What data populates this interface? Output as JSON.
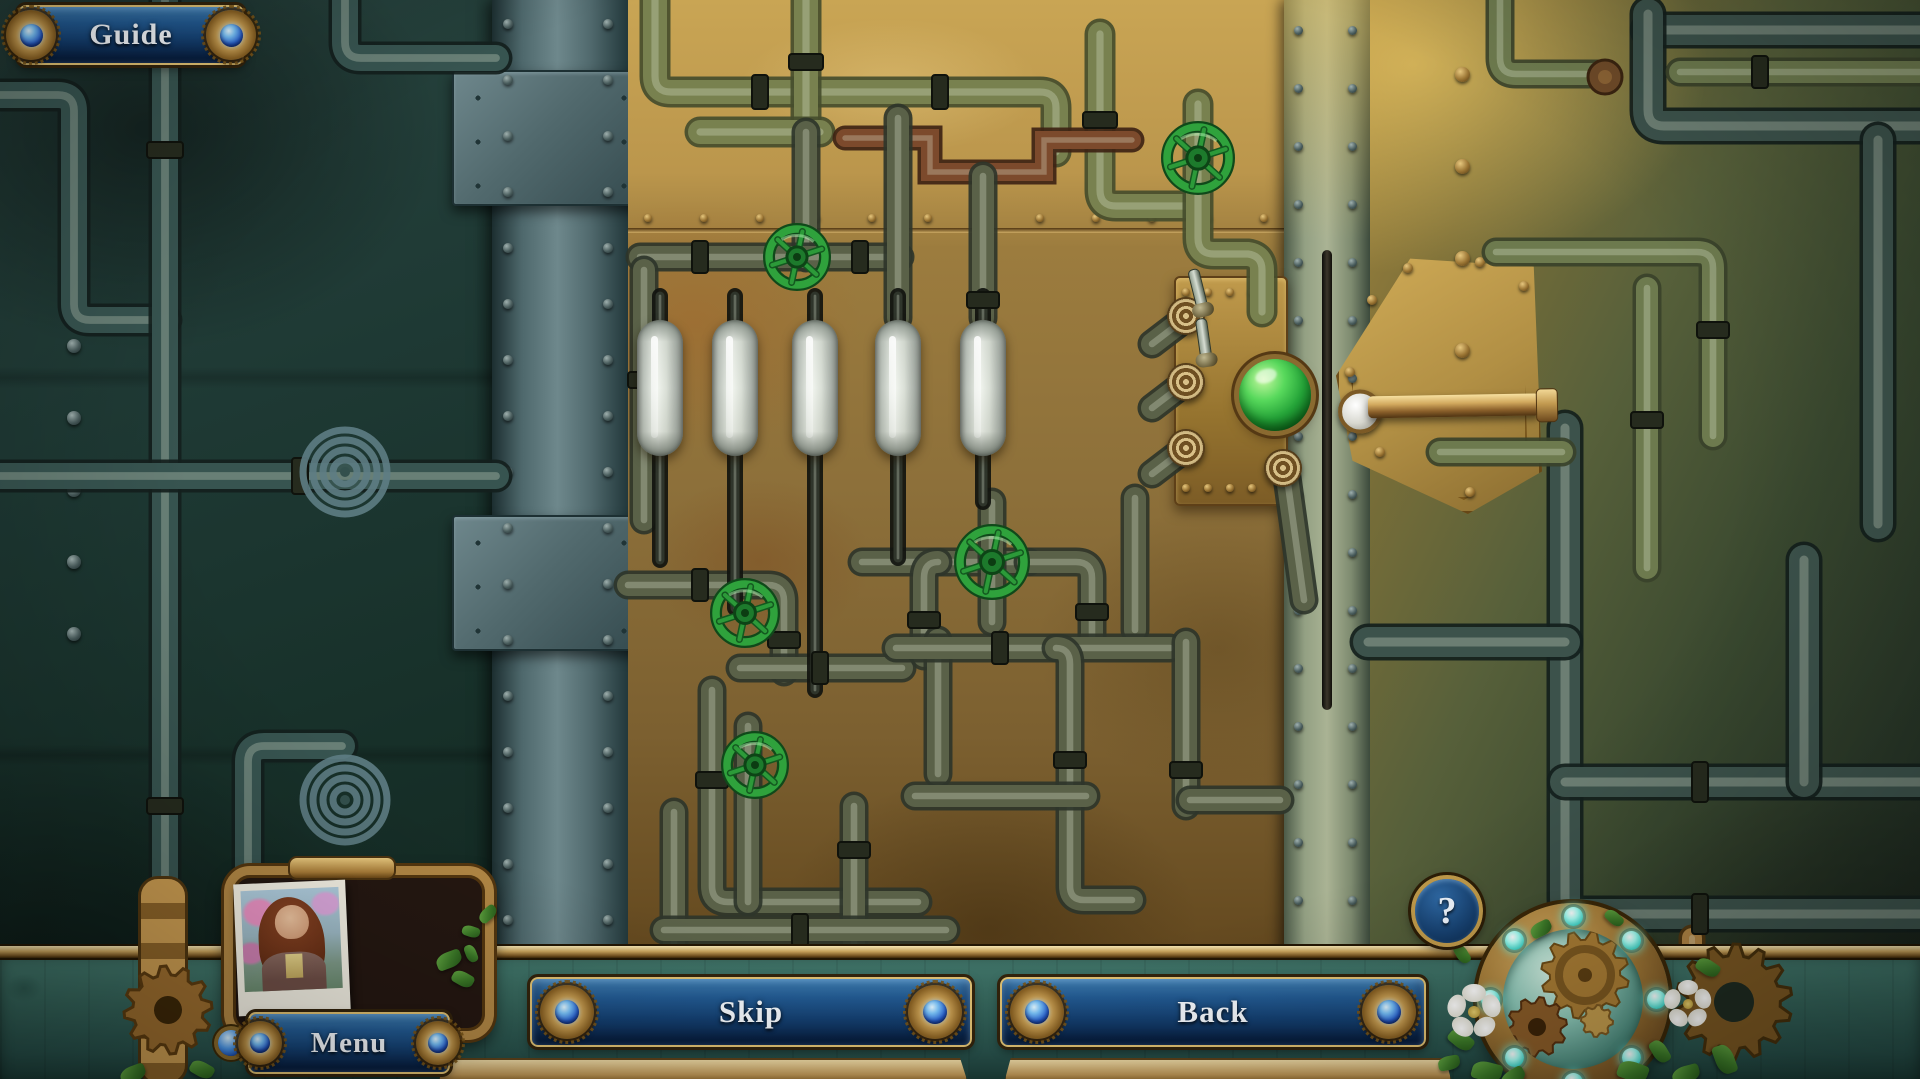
{
  "hud": {
    "guide": {
      "label": "Guide"
    },
    "skip": {
      "label": "Skip"
    },
    "back": {
      "label": "Back"
    },
    "menu": {
      "label": "Menu"
    },
    "help": {
      "label": "?"
    }
  },
  "icons": {
    "help": "question-mark",
    "banner_ornament": "blue-gem-rosette",
    "portrait": "woman-polaroid-photo",
    "device": "gear-compass-device",
    "valve": "green-handwheel",
    "gauge": "needle-dial"
  },
  "colors": {
    "banner_blue": "#1d4f7a",
    "banner_blue_dark": "#0c2c52",
    "gold_trim": "#c9a44e",
    "valve_green": "#2fa23c",
    "gauge_green": "#3fae4a",
    "needle_red": "#c4232f",
    "dome_green": "#24a338",
    "glow_cyan": "#7ff0ea",
    "brass_panel": "#8d703a",
    "teal_wall": "#1f3a35"
  },
  "puzzle": {
    "valves": [
      {
        "x": 797,
        "y": 257,
        "r": 28
      },
      {
        "x": 1198,
        "y": 158,
        "r": 31
      },
      {
        "x": 992,
        "y": 562,
        "r": 32
      },
      {
        "x": 745,
        "y": 613,
        "r": 29
      },
      {
        "x": 755,
        "y": 765,
        "r": 28
      }
    ],
    "gauges": [
      {
        "x": 898,
        "y": 182,
        "r": 46,
        "green_start": 0,
        "green_end": 115,
        "needle": 205
      },
      {
        "x": 983,
        "y": 252,
        "r": 46,
        "green_start": 140,
        "green_end": 215,
        "needle": 108
      },
      {
        "x": 1135,
        "y": 564,
        "r": 46,
        "green_start": 355,
        "green_end": 178,
        "needle": 93
      },
      {
        "x": 977,
        "y": 697,
        "r": 47,
        "green_start": 315,
        "green_end": 105,
        "needle": 30
      },
      {
        "x": 1190,
        "y": 717,
        "r": 47,
        "green_start": 185,
        "green_end": 300,
        "needle": 133
      }
    ],
    "cylinders": {
      "count": 5,
      "state": "empty",
      "x": [
        660,
        735,
        815,
        898,
        983
      ],
      "top": 320,
      "width": 46,
      "height": 136
    },
    "dome_button": {
      "x": 1275,
      "y": 395,
      "r": 36,
      "state": "lit-green"
    },
    "lever": {
      "x": 1352,
      "y": 404,
      "length": 205
    },
    "sockets": {
      "count": 4
    },
    "toggles": {
      "count": 2
    },
    "device_dots": {
      "count": 8
    }
  }
}
